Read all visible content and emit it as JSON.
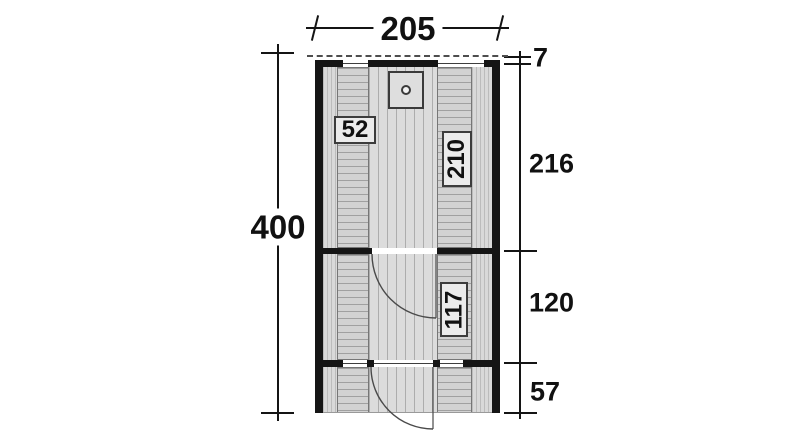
{
  "plan": {
    "title": "sauna-cabin-floor-plan",
    "dim_width": {
      "value": "205"
    },
    "dim_height": {
      "value": "400"
    },
    "dims_right": [
      {
        "id": "roof-overhang",
        "value": "7"
      },
      {
        "id": "sauna-room-depth",
        "value": "216"
      },
      {
        "id": "front-room-depth",
        "value": "120"
      },
      {
        "id": "terrace-depth",
        "value": "57"
      }
    ],
    "labels": {
      "left_bench": "52",
      "right_bench": "210",
      "front_bench": "117"
    },
    "colors": {
      "wall": "#151515",
      "floor": "#dcdcdc",
      "bench": "#d2d2d2",
      "dimension_line": "#141414",
      "background": "#ffffff"
    }
  }
}
